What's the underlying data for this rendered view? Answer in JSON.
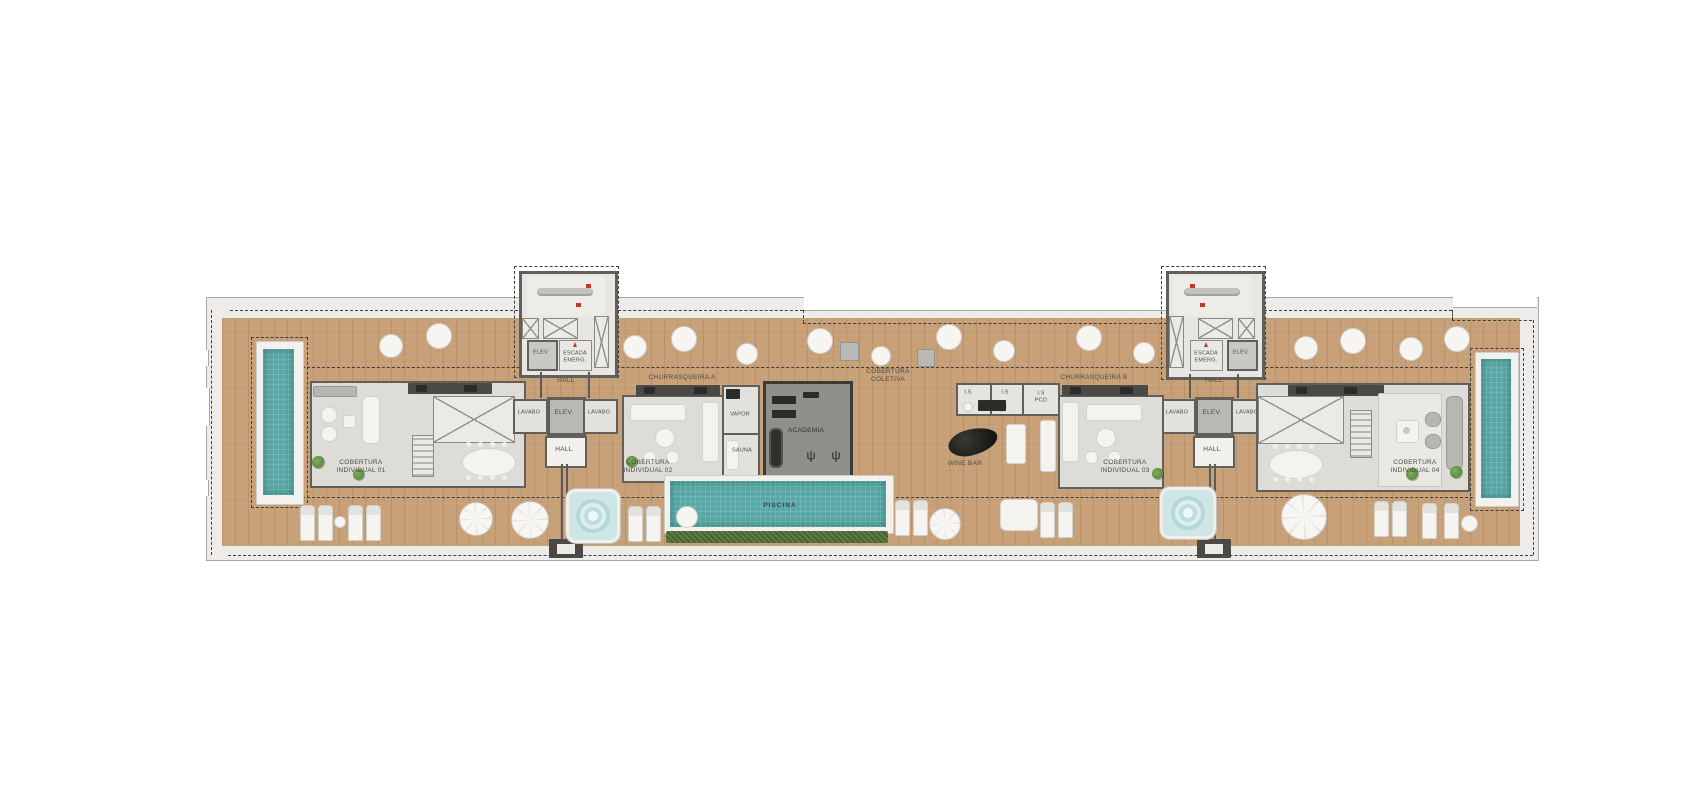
{
  "plan_type": "penthouse-rooftop-floor-plan",
  "labels": {
    "hall": "HALL",
    "elev": "ELEV.",
    "escada_emerg": "ESCADA\nEMERG.",
    "lavabo": "LAVABO",
    "cobertura_individual_01": "COBERTURA\nINDIVIDUAL 01",
    "cobertura_individual_02": "COBERTURA\nINDIVIDUAL 02",
    "cobertura_individual_03": "COBERTURA\nINDIVIDUAL 03",
    "cobertura_individual_04": "COBERTURA\nINDIVIDUAL 04",
    "churrasqueira_a": "CHURRASQUEIRA A",
    "churrasqueira_b": "CHURRASQUEIRA B",
    "cobertura_coletiva": "COBERTURA\nCOLETIVA",
    "vapor": "VAPOR",
    "sauna": "SAUNA",
    "academia": "ACADEMIA",
    "piscina": "PISCINA",
    "wine_bar": "WINE BAR",
    "is": "I.S",
    "is_pcd": "I.S\nPCD"
  },
  "colors": {
    "wood": "#c7a078",
    "slab": "#edecea",
    "room_floor": "#dedcd6",
    "wall": "#605f5b",
    "pool": "#57a8a6",
    "hedge": "#5c7d43",
    "jacuzzi": "#cfe6e6",
    "gym": "#8f8f8b",
    "dash": "#3f3e3a",
    "label": "#4b4a45",
    "accent_red": "#c0392b",
    "white_furniture": "#f4f3ef"
  }
}
